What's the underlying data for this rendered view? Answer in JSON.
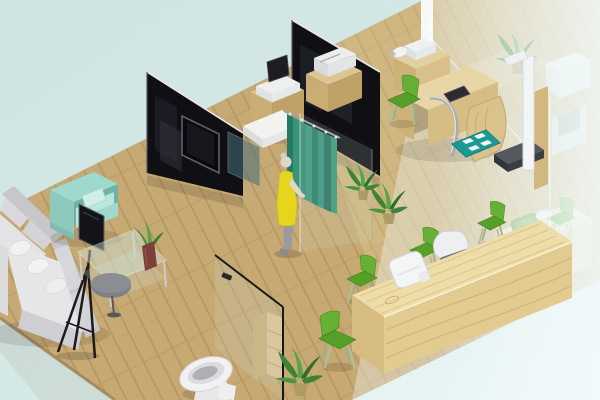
{
  "scene": {
    "type": "isometric-3d-interior-render",
    "description": "3D isometric rendering of a clinic interior with waiting area, exam stations, reception counter and toilet",
    "objects": [
      {
        "name": "wood-floor",
        "material": "light wood planks"
      },
      {
        "name": "black-glass-partition-left",
        "feature": "wall-mounted tv"
      },
      {
        "name": "black-glass-partition-center"
      },
      {
        "name": "frosted-glass-wall-right"
      },
      {
        "name": "waiting-sofa",
        "style": "L-shaped gray sectional with white pillows"
      },
      {
        "name": "mint-armchair"
      },
      {
        "name": "display-easel",
        "style": "black screen on tripod stand"
      },
      {
        "name": "glass-coffee-table",
        "accessory": "plant in brown vase"
      },
      {
        "name": "patient-figure",
        "outfit": "yellow tunic, gray pants"
      },
      {
        "name": "privacy-curtain",
        "color_name": "teal"
      },
      {
        "name": "printer-cabinet-a"
      },
      {
        "name": "printer-cabinet-b"
      },
      {
        "name": "exam-desk",
        "accessories": "camera device, tablet, chrome tube"
      },
      {
        "name": "teal-floor-mat"
      },
      {
        "name": "stadiometer-scale"
      },
      {
        "name": "reception-counter",
        "accessories": "white terminal, gray chair, green tray"
      },
      {
        "name": "green-side-chairs",
        "count": 6
      },
      {
        "name": "potted-plants",
        "count": 4
      },
      {
        "name": "toilet"
      },
      {
        "name": "toilet-glass-partition",
        "accessory": "wooden shelf"
      }
    ]
  },
  "colors": {
    "background": "#cfe4e2",
    "background_light": "#ecf8f7",
    "floor_wood": "#c7a973",
    "floor_wood_dark": "#b2935e",
    "floor_wood_light": "#e6d49e",
    "floor_edge": "#9a7f52",
    "wall_black": "#0f0f14",
    "wall_edge_highlight": "#e8e8ea",
    "tv_frame": "#606066",
    "curtain_teal": "#2e8a72",
    "curtain_teal_dark": "#267a63",
    "curtain_teal_light": "#3a9478",
    "sofa_gray": "#d9d9dd",
    "sofa_gray_dark": "#c6c6cb",
    "sofa_seat": "#e6e6e9",
    "armchair_mint": "#9fd8cd",
    "armchair_mint_light": "#b9e7de",
    "chair_green": "#57a028",
    "chair_green_light": "#66b135",
    "chair_leg_pale": "#aebf96",
    "counter_wood": "#eedca9",
    "counter_wood_front": "#e2cb90",
    "cabinet_wood": "#dcc593",
    "cabinet_wood_front": "#c9ad74",
    "plant_green": "#3f8436",
    "plant_green_light": "#57a546",
    "person_top_yellow": "#e6d51d",
    "person_pants_gray": "#9b9b9d",
    "person_skin": "#ded7ca",
    "device_white": "#f3f4f5",
    "mat_teal": "#1b9a91",
    "easel_black": "#1b1b1e",
    "vase_brown": "#7c4038",
    "platform_dark": "#3b3d42",
    "frosted_glass": "#eef7f7",
    "glass_tint": "#cde4dc"
  }
}
